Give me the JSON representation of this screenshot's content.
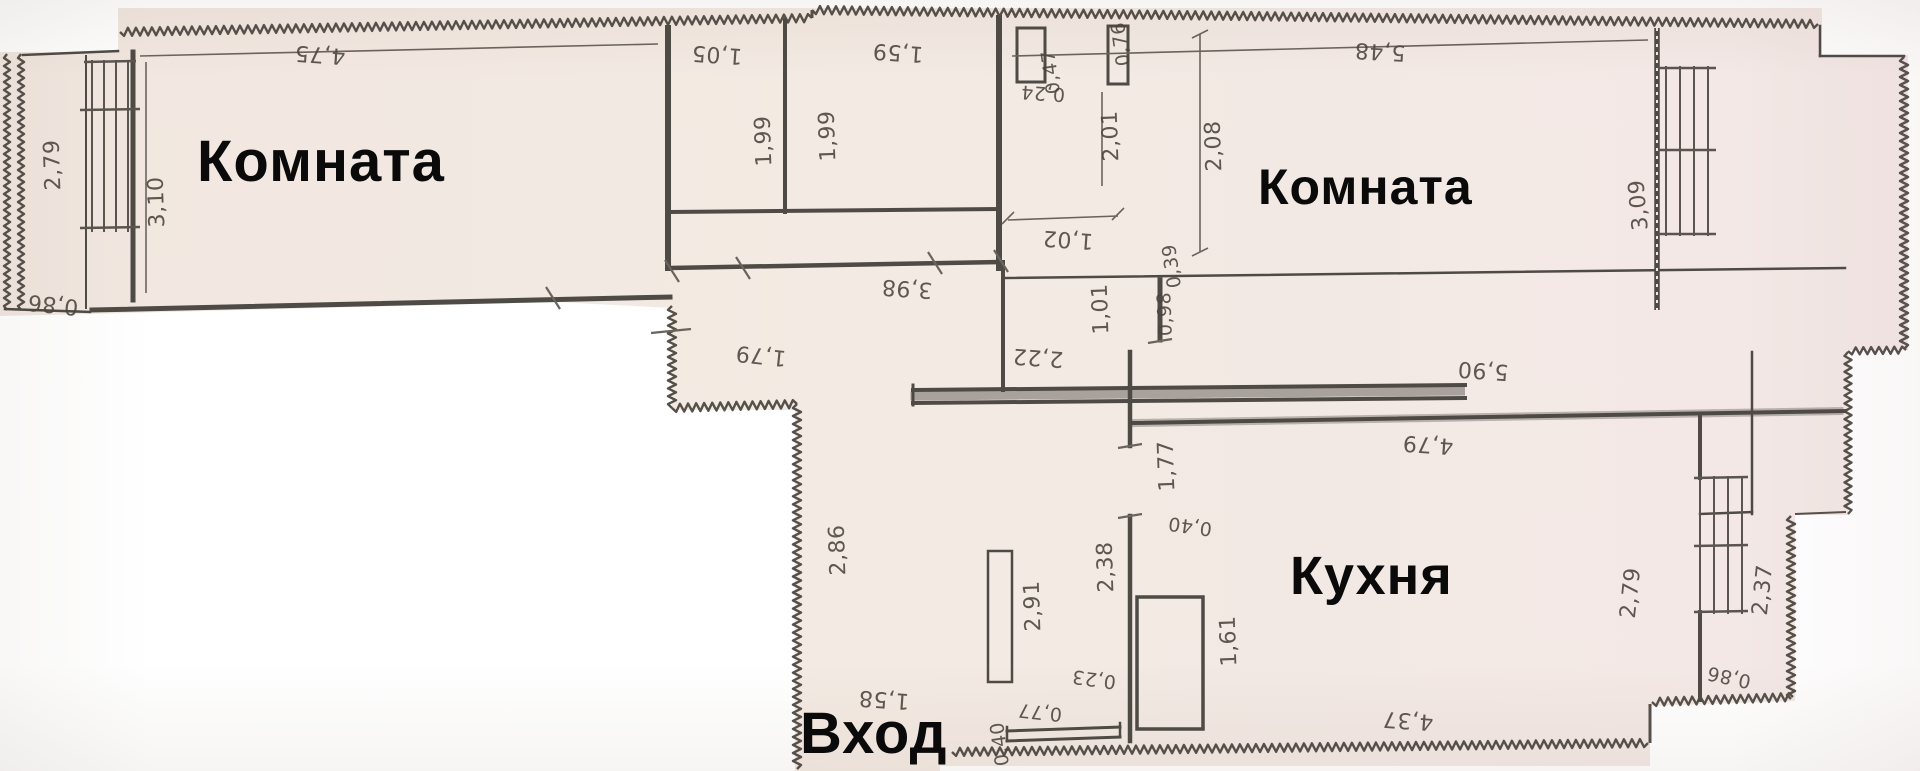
{
  "plan_type": "apartment floor plan (scanned)",
  "language": "ru",
  "rooms": {
    "room_left_label": "Комната",
    "room_right_label": "Комната",
    "kitchen_label": "Кухня",
    "entrance_label": "Вход"
  },
  "dimensions": {
    "balcony_left_height": "2,79",
    "balcony_left_width": "0,86",
    "room_left_width": "4,75",
    "room_left_depth": "3,10",
    "closet1_width": "1,05",
    "closet1_depth": "1,99",
    "closet2_width": "1,59",
    "closet2_depth": "1,99",
    "duct_width": "0,76",
    "duct_height": "0,47",
    "duct_offset": "0,24",
    "duct_wall": "2,01",
    "passage_top": "1,02",
    "room_right_width": "5,48",
    "room_right_left": "2,08",
    "room_right_right": "3,09",
    "corridor_length": "3,98",
    "corridor_width": "1,79",
    "lobby_width": "2,22",
    "lobby_opening": "1,01",
    "wall_stub": "0,98",
    "stub_offset": "0,39",
    "kitchen_wall": "5,90",
    "kitchen_width": "4,79",
    "kitchen_door": "1,77",
    "kitchen_offset": "0,40",
    "hall_wall": "2,38",
    "hall_door": "2,91",
    "kitchen_shaft": "1,61",
    "hall_offset_1": "0,23",
    "hall_offset_2": "0,77",
    "hall_offset_3": "0,40",
    "hall_width": "1,58",
    "hall_depth": "2,86",
    "kitchen_bottom": "4,37",
    "kbal_left": "2,79",
    "kbal_right": "2,37",
    "kbal_width": "0,86"
  },
  "colors": {
    "paper": "#f2e8e2",
    "paper_right": "#f3e9e6",
    "wall": "#524d47",
    "room_text": "#0a0a0a",
    "dim_text": "#4a443c",
    "background": "#ffffff"
  }
}
